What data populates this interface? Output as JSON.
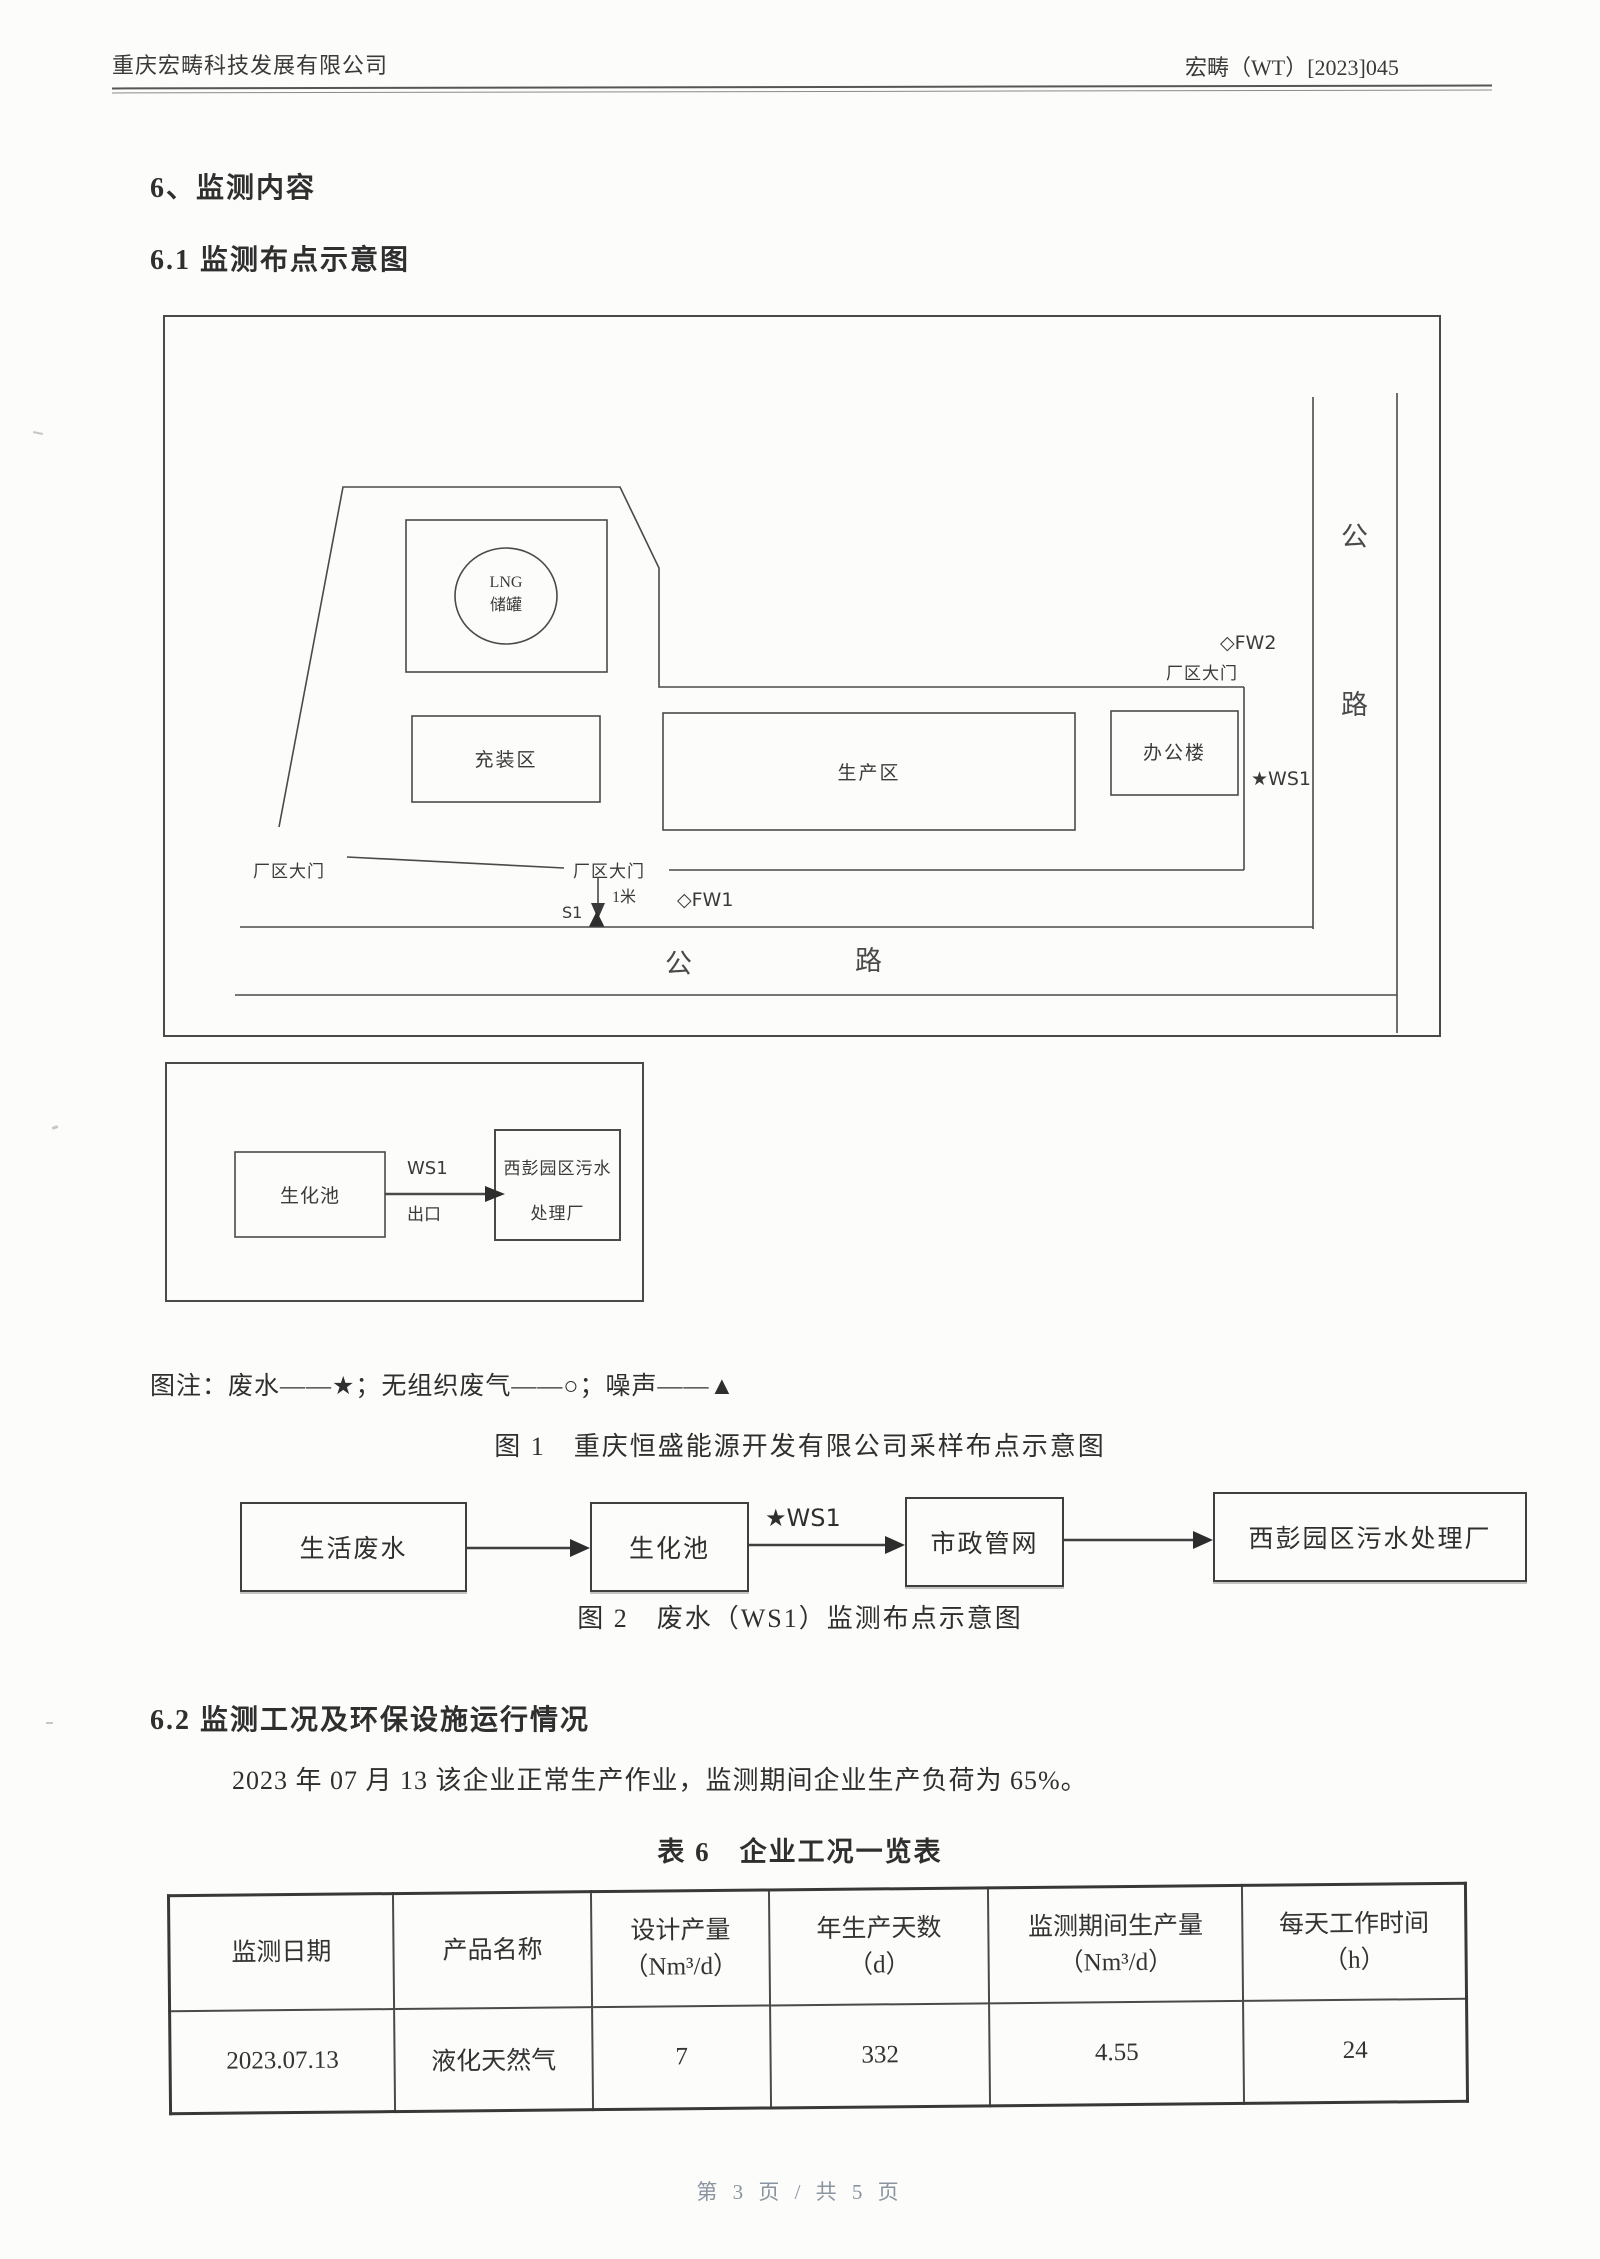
{
  "page": {
    "header": {
      "company": "重庆宏畴科技发展有限公司",
      "doc_number": "宏畴（WT）[2023]045"
    },
    "footer": {
      "page_indicator": "第 3 页 / 共 5 页"
    }
  },
  "headings": {
    "section6": "6、监测内容",
    "section6_1": "6.1 监测布点示意图",
    "section6_2": "6.2 监测工况及环保设施运行情况"
  },
  "figure1": {
    "site": {
      "lng_line1": "LNG",
      "lng_line2": "储罐",
      "filling_area": "充装区",
      "production_area": "生产区",
      "office_building": "办公楼",
      "gate_label": "厂区大门",
      "road_char1": "公",
      "road_char2": "路"
    },
    "markers": {
      "fw2": "◇FW2",
      "fw1": "◇FW1",
      "ws1": "★WS1",
      "s1": "S1",
      "noise_symbol": "▲",
      "distance": "1米"
    },
    "legend": "图注：废水——★；无组织废气——○；噪声——▲",
    "caption": "图 1　重庆恒盛能源开发有限公司采样布点示意图",
    "ws1_detail": {
      "tank": "生化池",
      "arrow_top": "WS1",
      "arrow_bottom": "出口",
      "plant_line1": "西彭园区污水",
      "plant_line2": "处理厂"
    }
  },
  "figure2": {
    "boxes": [
      "生活废水",
      "生化池",
      "市政管网",
      "西彭园区污水处理厂"
    ],
    "ws1_label": "★WS1",
    "caption": "图 2　废水（WS1）监测布点示意图"
  },
  "body_text": {
    "s62_paragraph": "2023 年 07 月 13 该企业正常生产作业，监测期间企业生产负荷为 65%。"
  },
  "table6": {
    "caption": "表 6　企业工况一览表",
    "headers": [
      {
        "label": "监测日期",
        "unit": ""
      },
      {
        "label": "产品名称",
        "unit": ""
      },
      {
        "label": "设计产量",
        "unit": "（Nm³/d）"
      },
      {
        "label": "年生产天数",
        "unit": "（d）"
      },
      {
        "label": "监测期间生产量",
        "unit": "（Nm³/d）"
      },
      {
        "label": "每天工作时间",
        "unit": "（h）"
      }
    ],
    "row": [
      "2023.07.13",
      "液化天然气",
      "7",
      "332",
      "4.55",
      "24"
    ]
  },
  "colors": {
    "text": "#2f2f2f",
    "line": "#4a4a4a",
    "footer_text": "#8a93a0",
    "paper": "#fcfcfb"
  }
}
